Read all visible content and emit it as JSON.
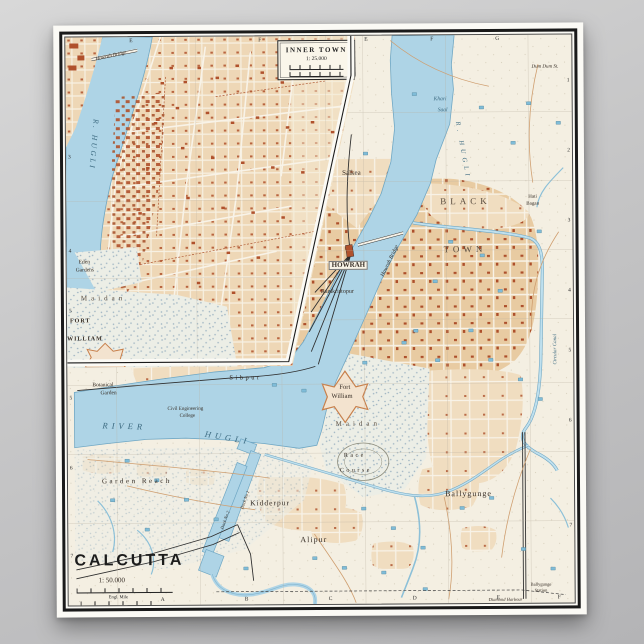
{
  "poster": {
    "map_title": "CALCUTTA",
    "map_scale": "1: 50.000",
    "scale_bars": {
      "mile": "Engl. Mile",
      "km": "Kilom."
    },
    "inset": {
      "title": "INNER TOWN",
      "scale": "1: 25.000"
    },
    "grid": {
      "inset_top": [
        "E",
        "F"
      ],
      "inset_left": [
        "3",
        "4",
        "5"
      ],
      "main_top": [
        "E",
        "F",
        "G"
      ],
      "main_right": [
        "1",
        "2",
        "3",
        "4",
        "5",
        "6",
        "7"
      ],
      "main_left": [
        "5",
        "6",
        "7"
      ],
      "main_bottom": [
        "A",
        "B",
        "C",
        "D",
        "E",
        "F"
      ]
    },
    "labels": {
      "inset_river": "R. HUGLI",
      "inset_bridge": "Howrah Bridge",
      "inset_eden1": "Eden",
      "inset_eden2": "Gardens",
      "inset_maidan": "Maidan",
      "inset_fort1": "FORT",
      "inset_fort2": "WILLIAM",
      "dum_dum": "Dum Dum St.",
      "khari1": "Khari",
      "khari2": "Saal",
      "upper_river": "R. HUGLI",
      "salkea": "Salkea",
      "howrah": "HOWRAH",
      "howrah_bridge": "Howrah Bridge",
      "ramkristopur": "Ramkristopur",
      "black": "BLACK",
      "town": "TOWN",
      "hati1": "Hati",
      "hati2": "Bagan",
      "circular_canal": "Circular Canal",
      "sibpur": "Sibpur",
      "botanical1": "Botanical",
      "botanical2": "Garden",
      "civil1": "Civil Engineering",
      "civil2": "College",
      "river_w": "RIVER",
      "hugli_w": "HUGLI",
      "garden_reach": "Garden Reach",
      "kidderpur": "Kidderpur",
      "dock1": "Dock No 1",
      "dock2": "Dock No 2",
      "fort_main1": "Fort",
      "fort_main2": "William",
      "maidan_main": "Maidan",
      "race1": "Race",
      "race2": "Course",
      "alipur": "Alipur",
      "ballygunge": "Ballygunge",
      "ballygunge_stn1": "Ballygunge",
      "ballygunge_stn2": "Station",
      "diamond": "Diamond Harbour"
    },
    "colors": {
      "water": "#aed4e6",
      "water_edge": "#6fa7c4",
      "town_fill": "#e8cba2",
      "buildings": "#b0512c",
      "paper": "#f4efe2",
      "stipple": "#9db3c2",
      "frame": "#1a1a1a"
    }
  }
}
